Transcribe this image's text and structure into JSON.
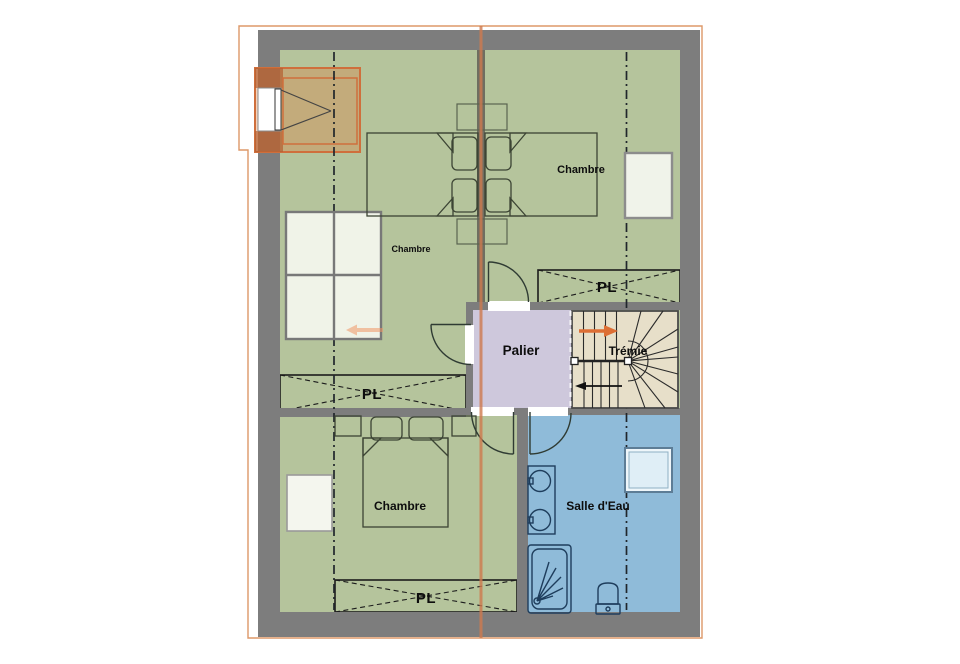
{
  "labels": {
    "bedroom_top_left": "Chambre",
    "bedroom_top_right": "Chambre",
    "bedroom_bottom": "Chambre",
    "landing": "Palier",
    "stairwell": "Trémie",
    "bathroom": "Salle d'Eau",
    "closet_top": "PL",
    "closet_middle": "PL",
    "closet_bottom": "PL"
  },
  "colors": {
    "floor_green": "#b5c49c",
    "bathroom_blue": "#8fbbd9",
    "landing_lavender": "#cec8dc",
    "stair_beige": "#e7dfc9",
    "wall_gray": "#7d7d7d",
    "roof_outline_orange": "#dd9868",
    "section_line_salmon": "#cf7a4e",
    "dormer_orange": "#cf6f3c",
    "stair_up_arrow_orange": "#dd6f35"
  }
}
